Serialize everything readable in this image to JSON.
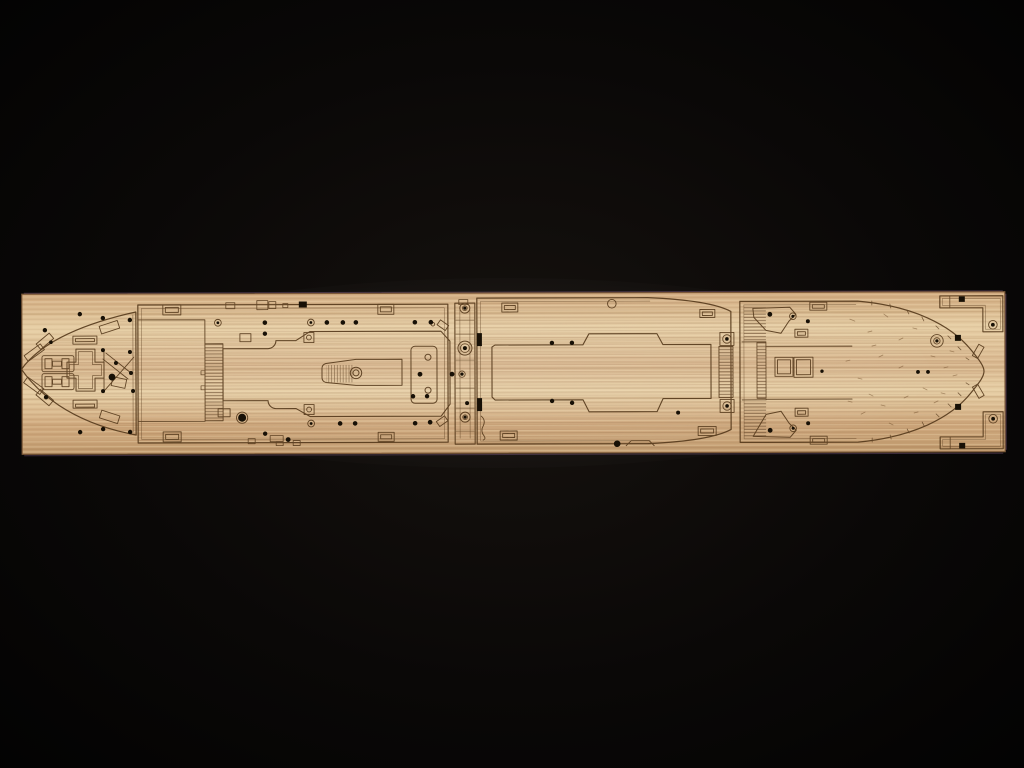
{
  "scene": {
    "type": "photograph",
    "subject": "laser-etched wooden deck sheet for a model ship kit",
    "background": "black cloth",
    "orientation": "horizontal strip; pointed bow deck at left, rounded stern deck at right",
    "texture": "light tan wood with horizontal grain and fine etched plank lines"
  },
  "sheet": {
    "pieces": [
      {
        "name": "forecastle-bow-deck",
        "position": "far-left",
        "features": "pointed bow outline, angled anchor slots, twin bollard fittings, cross-shaped hatch, drilled holes"
      },
      {
        "name": "main-boat-deck",
        "position": "center-left",
        "features": "superstructure footprint outline, ladder comb strip, tapered winch housing with round fitting, rounded equipment pad, porthole rows top and bottom"
      },
      {
        "name": "connector-strip",
        "position": "center",
        "features": "three ringed circular fittings"
      },
      {
        "name": "forward-well-deck",
        "position": "center-right",
        "features": "large hatch coaming outline with raised center, corner hatches, ringed tab fittings, comb edge"
      },
      {
        "name": "poop-stern-deck",
        "position": "right",
        "features": "rounded stern outline with plank tick marks, fan-shaped panels, twin square hatches, large ringed capstan base"
      },
      {
        "name": "corner-bracket-top-right",
        "position": "top-right corner",
        "features": "L-shaped bracket with ringed fitting"
      },
      {
        "name": "corner-bracket-bottom-right",
        "position": "bottom-right corner",
        "features": "L-shaped bracket with ringed fitting"
      }
    ]
  },
  "palette": {
    "background_center": "#16120f",
    "background_edge": "#020202",
    "wood_light": "#e7cfa6",
    "wood_base": "#d8b68e",
    "wood_mid": "#cfa87d",
    "wood_deep": "#c09a6e",
    "grain_light": "#f0dcb4",
    "grain_dark": "#9d7549",
    "plank_line": "#7d5331",
    "rung_line": "#5f4226",
    "etch_line": "#573b1d",
    "etch_soft": "#6b4826",
    "hole_fill": "#171006",
    "sheet_edge": "#7d5a39",
    "edge_fringe": "#9b6f9b"
  }
}
